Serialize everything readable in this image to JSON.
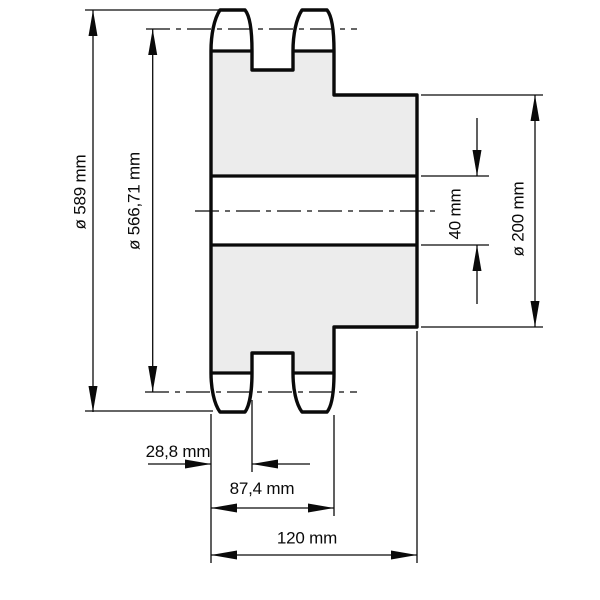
{
  "drawing": {
    "kind": "duplex-sprocket-cross-section",
    "labels": {
      "tip_diameter": "ø 589 mm",
      "pitch_diameter": "ø 566,71 mm",
      "bore_diameter": "40 mm",
      "hub_diameter": "ø 200 mm",
      "tooth_section_width": "28,8 mm",
      "teeth_span_width": "87,4 mm",
      "overall_width": "120 mm"
    },
    "colors": {
      "body_fill": "#ececec",
      "line": "#0a0a0a",
      "background": "#ffffff"
    }
  }
}
